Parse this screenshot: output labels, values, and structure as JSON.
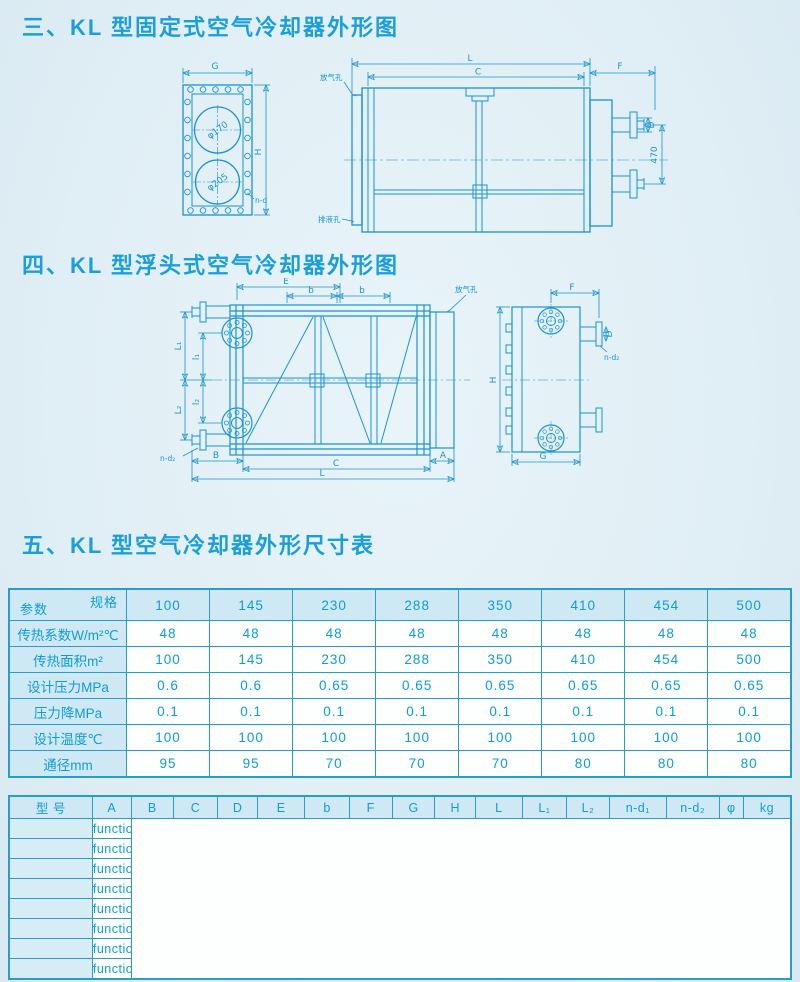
{
  "page": {
    "background": "#e2eff5",
    "line_color": "#1a94cf",
    "text_color": "#0e9bd8"
  },
  "sections": {
    "fixed_drawing_title": "三、KL 型固定式空气冷却器外形图",
    "floating_drawing_title": "四、KL 型浮头式空气冷却器外形图",
    "dimension_table_title": "五、KL 型空气冷却器外形尺寸表"
  },
  "drawing_fixed": {
    "labels": {
      "g": "G",
      "h": "H",
      "n_d": "n-d",
      "phi_top": "φ170",
      "phi_bottom": "φ205",
      "l": "L",
      "c": "C",
      "f": "F",
      "d": "D",
      "dim_470": "470",
      "vent": "放气孔",
      "drain": "排液孔"
    }
  },
  "drawing_floating": {
    "labels": {
      "e": "E",
      "b1": "b",
      "b2": "b",
      "cap_l1": "L₁",
      "cap_l2": "L₂",
      "low_l1": "l₁",
      "low_l2": "l₂",
      "vent": "放气孔",
      "n_d2_left": "n-d₂",
      "b": "B",
      "c": "C",
      "l": "L",
      "a": "A",
      "f": "F",
      "d": "D",
      "n_d2": "n-d₂",
      "h": "H",
      "g": "G"
    }
  },
  "spec_table": {
    "corner": {
      "top": "规格",
      "bottom": "参数"
    },
    "columns": [
      "100",
      "145",
      "230",
      "288",
      "350",
      "410",
      "454",
      "500"
    ],
    "rows": [
      {
        "label": "传热系数W/m²℃",
        "values": [
          "48",
          "48",
          "48",
          "48",
          "48",
          "48",
          "48",
          "48"
        ]
      },
      {
        "label": "传热面积m²",
        "values": [
          "100",
          "145",
          "230",
          "288",
          "350",
          "410",
          "454",
          "500"
        ]
      },
      {
        "label": "设计压力MPa",
        "values": [
          "0.6",
          "0.6",
          "0.65",
          "0.65",
          "0.65",
          "0.65",
          "0.65",
          "0.65"
        ]
      },
      {
        "label": "压力降MPa",
        "values": [
          "0.1",
          "0.1",
          "0.1",
          "0.1",
          "0.1",
          "0.1",
          "0.1",
          "0.1"
        ]
      },
      {
        "label": "设计温度℃",
        "values": [
          "100",
          "100",
          "100",
          "100",
          "100",
          "100",
          "100",
          "100"
        ]
      },
      {
        "label": "通径mm",
        "values": [
          "95",
          "95",
          "70",
          "70",
          "70",
          "80",
          "80",
          "80"
        ]
      }
    ]
  },
  "dim_table": {
    "columns": [
      "型  号",
      "A",
      "B",
      "C",
      "D",
      "E",
      "b",
      "F",
      "G",
      "H",
      "L",
      "L₁",
      "L₂",
      "n-d₁",
      "n-d₂",
      "φ",
      "kg"
    ],
    "rows": [
      [
        "KL-100",
        "",
        "",
        "1400",
        "170",
        "",
        "",
        "185",
        "320",
        "800",
        "1680",
        "",
        "",
        "4-φ18",
        "",
        "",
        "387"
      ],
      [
        "KL-145",
        "",
        "",
        "2000",
        "170",
        "",
        "",
        "185",
        "320",
        "800",
        "1680",
        "",
        "",
        "4-φ18",
        "",
        "",
        "465"
      ],
      [
        "KL-230",
        "150",
        "250",
        "1120",
        "140",
        "965",
        "210",
        "350",
        "490",
        "1358",
        "1620",
        "450",
        "600",
        "4-φ19",
        "",
        "65",
        "1400"
      ],
      [
        "KL-288",
        "150",
        "250",
        "1400",
        "140",
        "825",
        "450",
        "350",
        "490",
        "1358",
        "1850",
        "450",
        "600",
        "4-φ19",
        "4-φ14",
        "65",
        "1500"
      ],
      [
        "KL-350",
        "150",
        "250",
        "1700",
        "140",
        "975",
        "600",
        "350",
        "490",
        "1358",
        "2150",
        "450",
        "600",
        "4-φ19",
        "4-φ14",
        "65",
        "1520"
      ],
      [
        "KL-410",
        "150",
        "250",
        "2025",
        "150",
        "1135",
        "740",
        "350",
        "490",
        "1358",
        "2475",
        "450",
        "600",
        "4-φ19",
        "4-φ14",
        "65",
        "1550"
      ],
      [
        "KL-454",
        "150",
        "250",
        "2245",
        "150",
        "1245",
        "850",
        "350",
        "490",
        "1358",
        "2695",
        "450",
        "600",
        "8-φ18",
        "4-φ14",
        "65",
        "1840"
      ],
      [
        "KL-500",
        "150",
        "250",
        "2465",
        "150",
        "1355",
        "960",
        "350",
        "490",
        "1358",
        "2915",
        "450",
        "600",
        "8-φ18",
        "4-φ14",
        "65",
        "2021"
      ]
    ]
  }
}
